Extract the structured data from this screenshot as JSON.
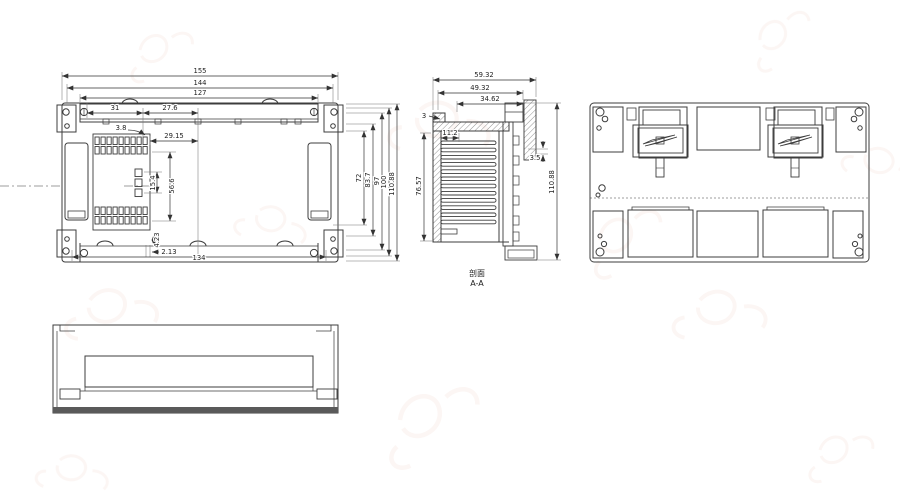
{
  "views": {
    "front": {
      "d155": "155",
      "d144": "144",
      "d127": "127",
      "d31": "31",
      "d27_6": "27.6",
      "d3_8": "3.8",
      "d29_15": "29.15",
      "d15_4": "15.4",
      "d56_6": "56.6",
      "d4_23": "4.23",
      "d2_13": "2.13",
      "d134": "134",
      "d72": "72",
      "d83_7": "83.7",
      "d97": "97",
      "d100": "100",
      "d110_88": "110.88"
    },
    "section": {
      "label1": "剖面",
      "label2": "A-A",
      "d59_32": "59.32",
      "d49_32": "49.32",
      "d34_62": "34.62",
      "d3": "3",
      "d11_2": "11.2",
      "d3_5": "3.5",
      "d76_57": "76.57",
      "d110_88": "110.88"
    }
  },
  "colors": {
    "line": "#3c3c3c",
    "dim": "#333333",
    "watermark": "#c4643c"
  }
}
